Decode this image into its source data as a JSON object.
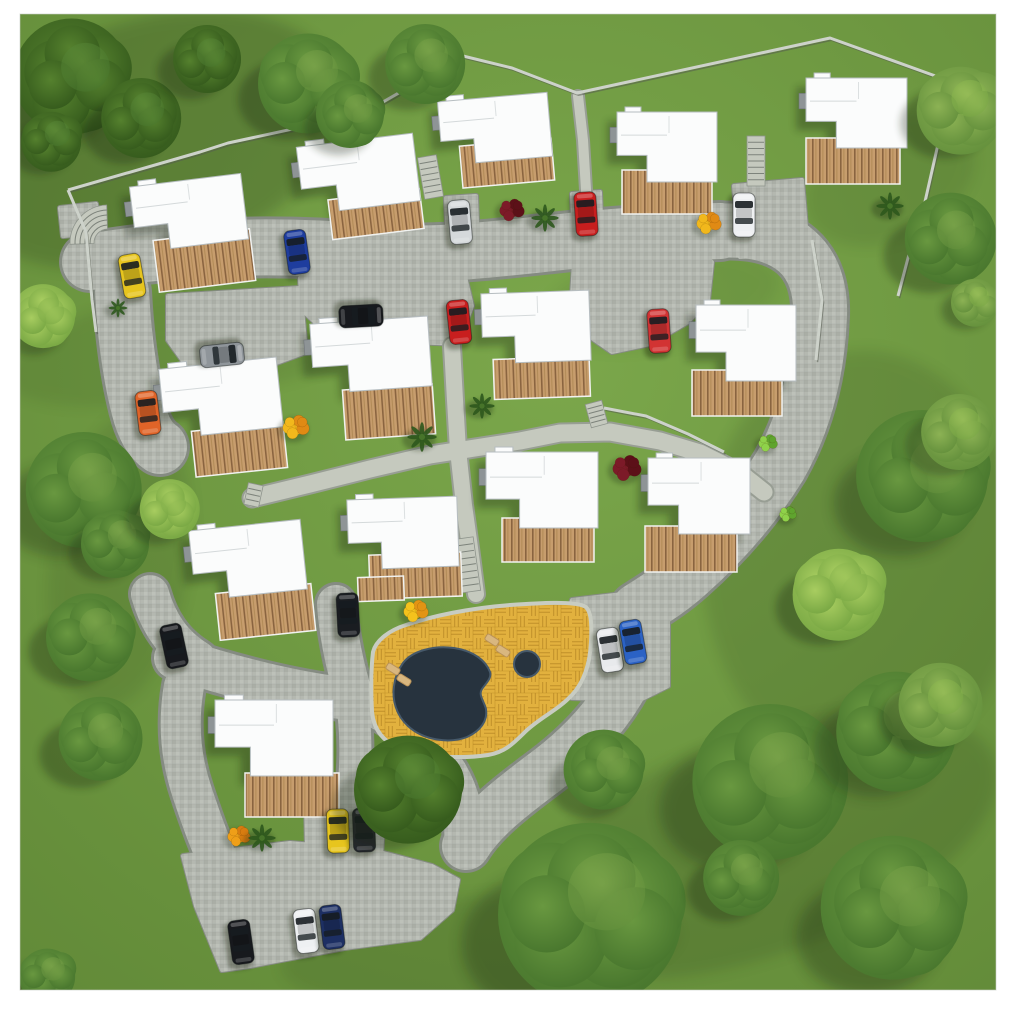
{
  "meta": {
    "description": "Aerial top-down 3D site plan rendering of a residential estate: 14 detached houses with wooden decks, cobblestone roads, parked cars, communal pool terrace and surrounding trees",
    "view": "top-down",
    "canvas": {
      "width": 1024,
      "height": 1017
    }
  },
  "frame": {
    "bg": "#ffffff",
    "left": 20,
    "top": 14,
    "right": 996,
    "bottom": 990
  },
  "palette": {
    "grass1": "#76a147",
    "grass2": "#5d8435",
    "roadEdge": "#858b82",
    "road": "#b4b8b0",
    "pathFill": "#c5c9be",
    "pathEdge": "#989e94",
    "curb": "#d6d9d1",
    "wallLight": "#cdd2ca",
    "wallDark": "#565b50",
    "roofFill": "#fbfcfc",
    "roofEdge": "#b6bdc0",
    "entry": "#8e9496",
    "woodLight": "#c79d6d",
    "woodDark": "#8a6440",
    "deckTrim": "#f1f2f0",
    "patio1": "#e2b13e",
    "patio2": "#c08f2a",
    "patioCurb": "#c8ccc2",
    "water": "#27333e",
    "waterEdge": "#46596a",
    "chair": "#d9b77f",
    "chairEdge": "#b99258",
    "shadow": "#16230c"
  },
  "shading": [
    [
      150,
      140,
      200,
      120,
      -18,
      0.2
    ],
    [
      240,
      330,
      240,
      60,
      -12,
      0.09
    ],
    [
      120,
      560,
      70,
      150,
      8,
      0.1
    ],
    [
      862,
      560,
      160,
      210,
      0,
      0.12
    ],
    [
      760,
      845,
      250,
      110,
      -20,
      0.15
    ],
    [
      480,
      950,
      200,
      55,
      -5,
      0.1
    ],
    [
      335,
      748,
      85,
      48,
      -15,
      0.12
    ],
    [
      660,
      300,
      120,
      48,
      -10,
      0.07
    ],
    [
      890,
      180,
      90,
      60,
      -25,
      0.1
    ]
  ],
  "roads": {
    "segments": [
      {
        "d": "M 90 262 C 180 246 280 244 370 252 C 440 258 520 246 580 240 C 640 234 685 232 720 231",
        "w": 56
      },
      {
        "d": "M 714 231 C 792 226 822 262 820 316 C 818 368 806 420 780 466 C 754 508 722 544 688 574 C 668 592 650 602 638 610",
        "w": 54
      },
      {
        "d": "M 636 660 C 618 706 585 742 545 772 C 510 798 482 820 466 846",
        "w": 48
      },
      {
        "d": "M 358 700 C 396 714 426 740 448 774 C 460 794 466 820 464 845",
        "w": 40
      },
      {
        "d": "M 175 658 C 235 678 298 694 358 700",
        "w": 42
      },
      {
        "d": "M 150 594 C 158 622 172 644 198 660",
        "w": 38
      },
      {
        "d": "M 184 686 C 178 720 180 756 192 792 C 202 822 212 850 226 878",
        "w": 40
      },
      {
        "d": "M 336 604 C 338 634 344 662 352 690",
        "w": 38
      },
      {
        "d": "M 350 692 C 357 726 357 766 351 810",
        "w": 32
      },
      {
        "d": "M 122 292 C 124 330 128 368 138 408 C 143 428 150 440 160 447",
        "w": 54
      }
    ],
    "aprons": [
      "300,278 462,264 472,306 458,344 332,338 302,310",
      "574,262 700,252 712,262 708,300 688,322 650,344 612,352 580,330 572,296",
      "734,186 802,180 808,252 740,257",
      "572,600 656,590 668,602 668,686 640,700 572,698 560,644",
      "183,856 290,843 372,850 432,866 458,880 452,910 420,938 344,948 250,966 222,970 196,906",
      "306,800 384,806 381,856 307,851",
      "60,208 96,204 99,232 63,236",
      "168,296 300,288 306,352 252,372 188,368 168,340",
      "446,198 476,196 478,248 448,250",
      "572,194 600,192 602,242 574,244"
    ]
  },
  "footpaths": [
    {
      "d": "M 252 498 L 310 484 L 370 469 L 430 455 L 475 448 L 520 441 L 560 433 L 610 432 L 660 441 L 700 453 L 740 473 L 764 492",
      "w": 17
    },
    {
      "d": "M 452 346 L 455 400 L 458 450 L 464 505 L 470 548 L 476 594",
      "w": 16
    },
    {
      "d": "M 578 96 L 583 140 L 586 190 L 586 212",
      "w": 10
    }
  ],
  "stairs": [
    {
      "x": 421,
      "y": 156,
      "w": 19,
      "h": 42,
      "rot": -10,
      "n": 7
    },
    {
      "x": 747,
      "y": 136,
      "w": 18,
      "h": 50,
      "rot": 0,
      "n": 8
    },
    {
      "x": 588,
      "y": 402,
      "w": 17,
      "h": 24,
      "rot": -15,
      "n": 5
    },
    {
      "x": 456,
      "y": 538,
      "w": 21,
      "h": 54,
      "rot": -8,
      "n": 8
    },
    {
      "x": 246,
      "y": 484,
      "w": 15,
      "h": 22,
      "rot": 12,
      "n": 4
    }
  ],
  "curved_stair": {
    "cx": 108,
    "cy": 243,
    "r1": 14,
    "r2": 38,
    "rungs": [
      18,
      23,
      28,
      33
    ],
    "a1": 178,
    "a2": 268
  },
  "walls": [
    "68,190 200,152 228,143 362,114 463,56 512,68 577,93 830,38 952,82 948,100 922,215 908,258 898,296",
    "68,190 86,232 92,300 96,332",
    "812,240 822,300 816,360",
    "604,408 646,416 688,434 724,452"
  ],
  "pool": {
    "patio": "M 373 652 C 376 640 390 630 406 625 C 432 616 470 608 510 605 C 540 603 572 601 584 606 C 591 609 592 622 591 642 C 590 663 585 681 572 695 C 558 710 541 717 526 731 C 513 744 505 752 488 755 C 462 759 428 757 404 750 C 386 744 374 732 372 712 C 371 692 371 668 373 652 Z",
    "water": "M 403 663 C 412 651 434 645 454 648 C 474 651 486 661 490 672 C 492 678 486 683 482 689 C 478 695 484 701 486 709 C 488 721 480 731 467 737 C 449 744 423 740 408 726 C 396 715 392 700 394 686 C 395 677 398 670 403 663 Z",
    "spa": {
      "cx": 527,
      "cy": 664,
      "r": 13
    },
    "chairs": [
      [
        393,
        669,
        32
      ],
      [
        404,
        680,
        32
      ],
      [
        492,
        640,
        32
      ],
      [
        503,
        651,
        32
      ]
    ]
  },
  "houses": [
    {
      "x": 133,
      "y": 180,
      "w": 112,
      "h": 66,
      "rot": -7,
      "decks": [
        [
          150,
          236,
          97,
          52
        ]
      ]
    },
    {
      "x": 300,
      "y": 140,
      "w": 117,
      "h": 68,
      "rot": -7,
      "decks": [
        [
          325,
          196,
          92,
          40
        ]
      ]
    },
    {
      "x": 440,
      "y": 97,
      "w": 110,
      "h": 64,
      "rot": -5,
      "decks": [
        [
          458,
          143,
          92,
          42
        ]
      ]
    },
    {
      "x": 617,
      "y": 112,
      "w": 100,
      "h": 70,
      "rot": 0,
      "decks": [
        [
          622,
          170,
          90,
          44
        ]
      ]
    },
    {
      "x": 806,
      "y": 78,
      "w": 101,
      "h": 70,
      "rot": 0,
      "decks": [
        [
          806,
          138,
          94,
          46
        ]
      ]
    },
    {
      "x": 162,
      "y": 363,
      "w": 118,
      "h": 70,
      "rot": -6,
      "decks": [
        [
          188,
          428,
          92,
          46
        ]
      ]
    },
    {
      "x": 312,
      "y": 320,
      "w": 118,
      "h": 70,
      "rot": -4,
      "decks": [
        [
          340,
          388,
          90,
          50
        ]
      ]
    },
    {
      "x": 482,
      "y": 292,
      "w": 108,
      "h": 70,
      "rot": -2,
      "decks": [
        [
          492,
          358,
          96,
          40
        ]
      ]
    },
    {
      "x": 696,
      "y": 305,
      "w": 100,
      "h": 76,
      "rot": 0,
      "decks": [
        [
          692,
          370,
          90,
          46
        ]
      ]
    },
    {
      "x": 192,
      "y": 525,
      "w": 112,
      "h": 70,
      "rot": -6,
      "decks": [
        [
          212,
          590,
          96,
          47
        ]
      ]
    },
    {
      "x": 348,
      "y": 498,
      "w": 110,
      "h": 70,
      "rot": -2,
      "decks": [
        [
          368,
          554,
          92,
          44
        ],
        [
          356,
          576,
          46,
          24
        ]
      ]
    },
    {
      "x": 486,
      "y": 452,
      "w": 112,
      "h": 76,
      "rot": 0,
      "decks": [
        [
          502,
          518,
          92,
          44
        ]
      ]
    },
    {
      "x": 648,
      "y": 458,
      "w": 102,
      "h": 76,
      "rot": 0,
      "decks": [
        [
          645,
          526,
          92,
          46
        ]
      ]
    },
    {
      "x": 215,
      "y": 700,
      "w": 118,
      "h": 76,
      "rot": 0,
      "decks": [
        [
          245,
          773,
          94,
          44
        ]
      ]
    }
  ],
  "cars": [
    {
      "color": "#e7c51e",
      "x": 132,
      "y": 276,
      "rot": -10,
      "name": "yellow"
    },
    {
      "color": "#1e3d9e",
      "x": 297,
      "y": 252,
      "rot": -8,
      "name": "blue"
    },
    {
      "color": "#d5d9db",
      "x": 460,
      "y": 222,
      "rot": -5,
      "name": "silver"
    },
    {
      "color": "#c81e1e",
      "x": 586,
      "y": 214,
      "rot": -4,
      "name": "red"
    },
    {
      "color": "#eef0f2",
      "x": 744,
      "y": 215,
      "rot": 0,
      "name": "white"
    },
    {
      "color": "#17191d",
      "x": 361,
      "y": 316,
      "rot": 87,
      "name": "black"
    },
    {
      "color": "#c81e1e",
      "x": 459,
      "y": 322,
      "rot": -6,
      "name": "red"
    },
    {
      "color": "#d23333",
      "x": 659,
      "y": 331,
      "rot": -4,
      "name": "red"
    },
    {
      "color": "#8f959a",
      "x": 222,
      "y": 355,
      "rot": 84,
      "name": "gray"
    },
    {
      "color": "#e06428",
      "x": 148,
      "y": 413,
      "rot": -7,
      "name": "orange"
    },
    {
      "color": "#1a1d21",
      "x": 348,
      "y": 615,
      "rot": -3,
      "name": "black"
    },
    {
      "color": "#17191d",
      "x": 174,
      "y": 646,
      "rot": -12,
      "name": "black"
    },
    {
      "color": "#e8eaec",
      "x": 610,
      "y": 650,
      "rot": -9,
      "name": "white"
    },
    {
      "color": "#2b62c5",
      "x": 633,
      "y": 642,
      "rot": -10,
      "name": "blue"
    },
    {
      "color": "#e7c51e",
      "x": 338,
      "y": 831,
      "rot": -2,
      "name": "yellow"
    },
    {
      "color": "#26292e",
      "x": 364,
      "y": 830,
      "rot": -2,
      "name": "black"
    },
    {
      "color": "#17191d",
      "x": 241,
      "y": 942,
      "rot": -8,
      "name": "black"
    },
    {
      "color": "#eef0f2",
      "x": 306,
      "y": 931,
      "rot": -7,
      "name": "white"
    },
    {
      "color": "#1d2f63",
      "x": 332,
      "y": 927,
      "rot": -7,
      "name": "navy"
    }
  ],
  "bushes": [
    {
      "x": 296,
      "y": 427,
      "r": 14,
      "c1": "#f2b81c",
      "c2": "#e08a14"
    },
    {
      "x": 709,
      "y": 223,
      "r": 13,
      "c1": "#f2b81c",
      "c2": "#e08a14"
    },
    {
      "x": 416,
      "y": 611,
      "r": 13,
      "c1": "#f4c21c",
      "c2": "#e29414"
    },
    {
      "x": 239,
      "y": 836,
      "r": 12,
      "c1": "#ef9f18",
      "c2": "#d87c10"
    },
    {
      "x": 512,
      "y": 210,
      "r": 13,
      "c1": "#7c1a28",
      "c2": "#5c1018"
    },
    {
      "x": 627,
      "y": 468,
      "r": 15,
      "c1": "#7c1a28",
      "c2": "#5c1018"
    },
    {
      "x": 768,
      "y": 443,
      "r": 10,
      "c1": "#8fd24a",
      "c2": "#5fa42e"
    },
    {
      "x": 788,
      "y": 514,
      "r": 9,
      "c1": "#8fd24a",
      "c2": "#5fa42e"
    }
  ],
  "palms": [
    [
      545,
      218,
      13
    ],
    [
      890,
      206,
      13
    ],
    [
      422,
      437,
      14
    ],
    [
      482,
      406,
      12
    ],
    [
      262,
      838,
      13
    ],
    [
      118,
      308,
      9
    ]
  ],
  "trees": [
    [
      75,
      80,
      58,
      "dark"
    ],
    [
      140,
      118,
      40,
      "dark"
    ],
    [
      52,
      140,
      30,
      "dark"
    ],
    [
      205,
      60,
      34,
      "dark"
    ],
    [
      308,
      82,
      50,
      "mid"
    ],
    [
      352,
      116,
      34,
      "mid"
    ],
    [
      424,
      64,
      40,
      "mid"
    ],
    [
      962,
      108,
      44,
      "light"
    ],
    [
      948,
      240,
      46,
      "mid"
    ],
    [
      975,
      302,
      24,
      "light"
    ],
    [
      45,
      318,
      32,
      "bright"
    ],
    [
      82,
      490,
      58,
      "mid"
    ],
    [
      116,
      542,
      34,
      "mid"
    ],
    [
      168,
      510,
      30,
      "bright"
    ],
    [
      90,
      636,
      44,
      "mid"
    ],
    [
      926,
      480,
      66,
      "mid"
    ],
    [
      958,
      432,
      38,
      "light"
    ],
    [
      840,
      592,
      46,
      "bright"
    ],
    [
      98,
      740,
      42,
      "mid"
    ],
    [
      408,
      788,
      54,
      "dark"
    ],
    [
      606,
      772,
      40,
      "mid"
    ],
    [
      768,
      782,
      78,
      "mid"
    ],
    [
      898,
      728,
      60,
      "mid"
    ],
    [
      938,
      706,
      42,
      "light"
    ],
    [
      590,
      912,
      92,
      "mid"
    ],
    [
      897,
      912,
      72,
      "mid"
    ],
    [
      740,
      878,
      38,
      "mid"
    ],
    [
      48,
      975,
      28,
      "mid"
    ]
  ]
}
